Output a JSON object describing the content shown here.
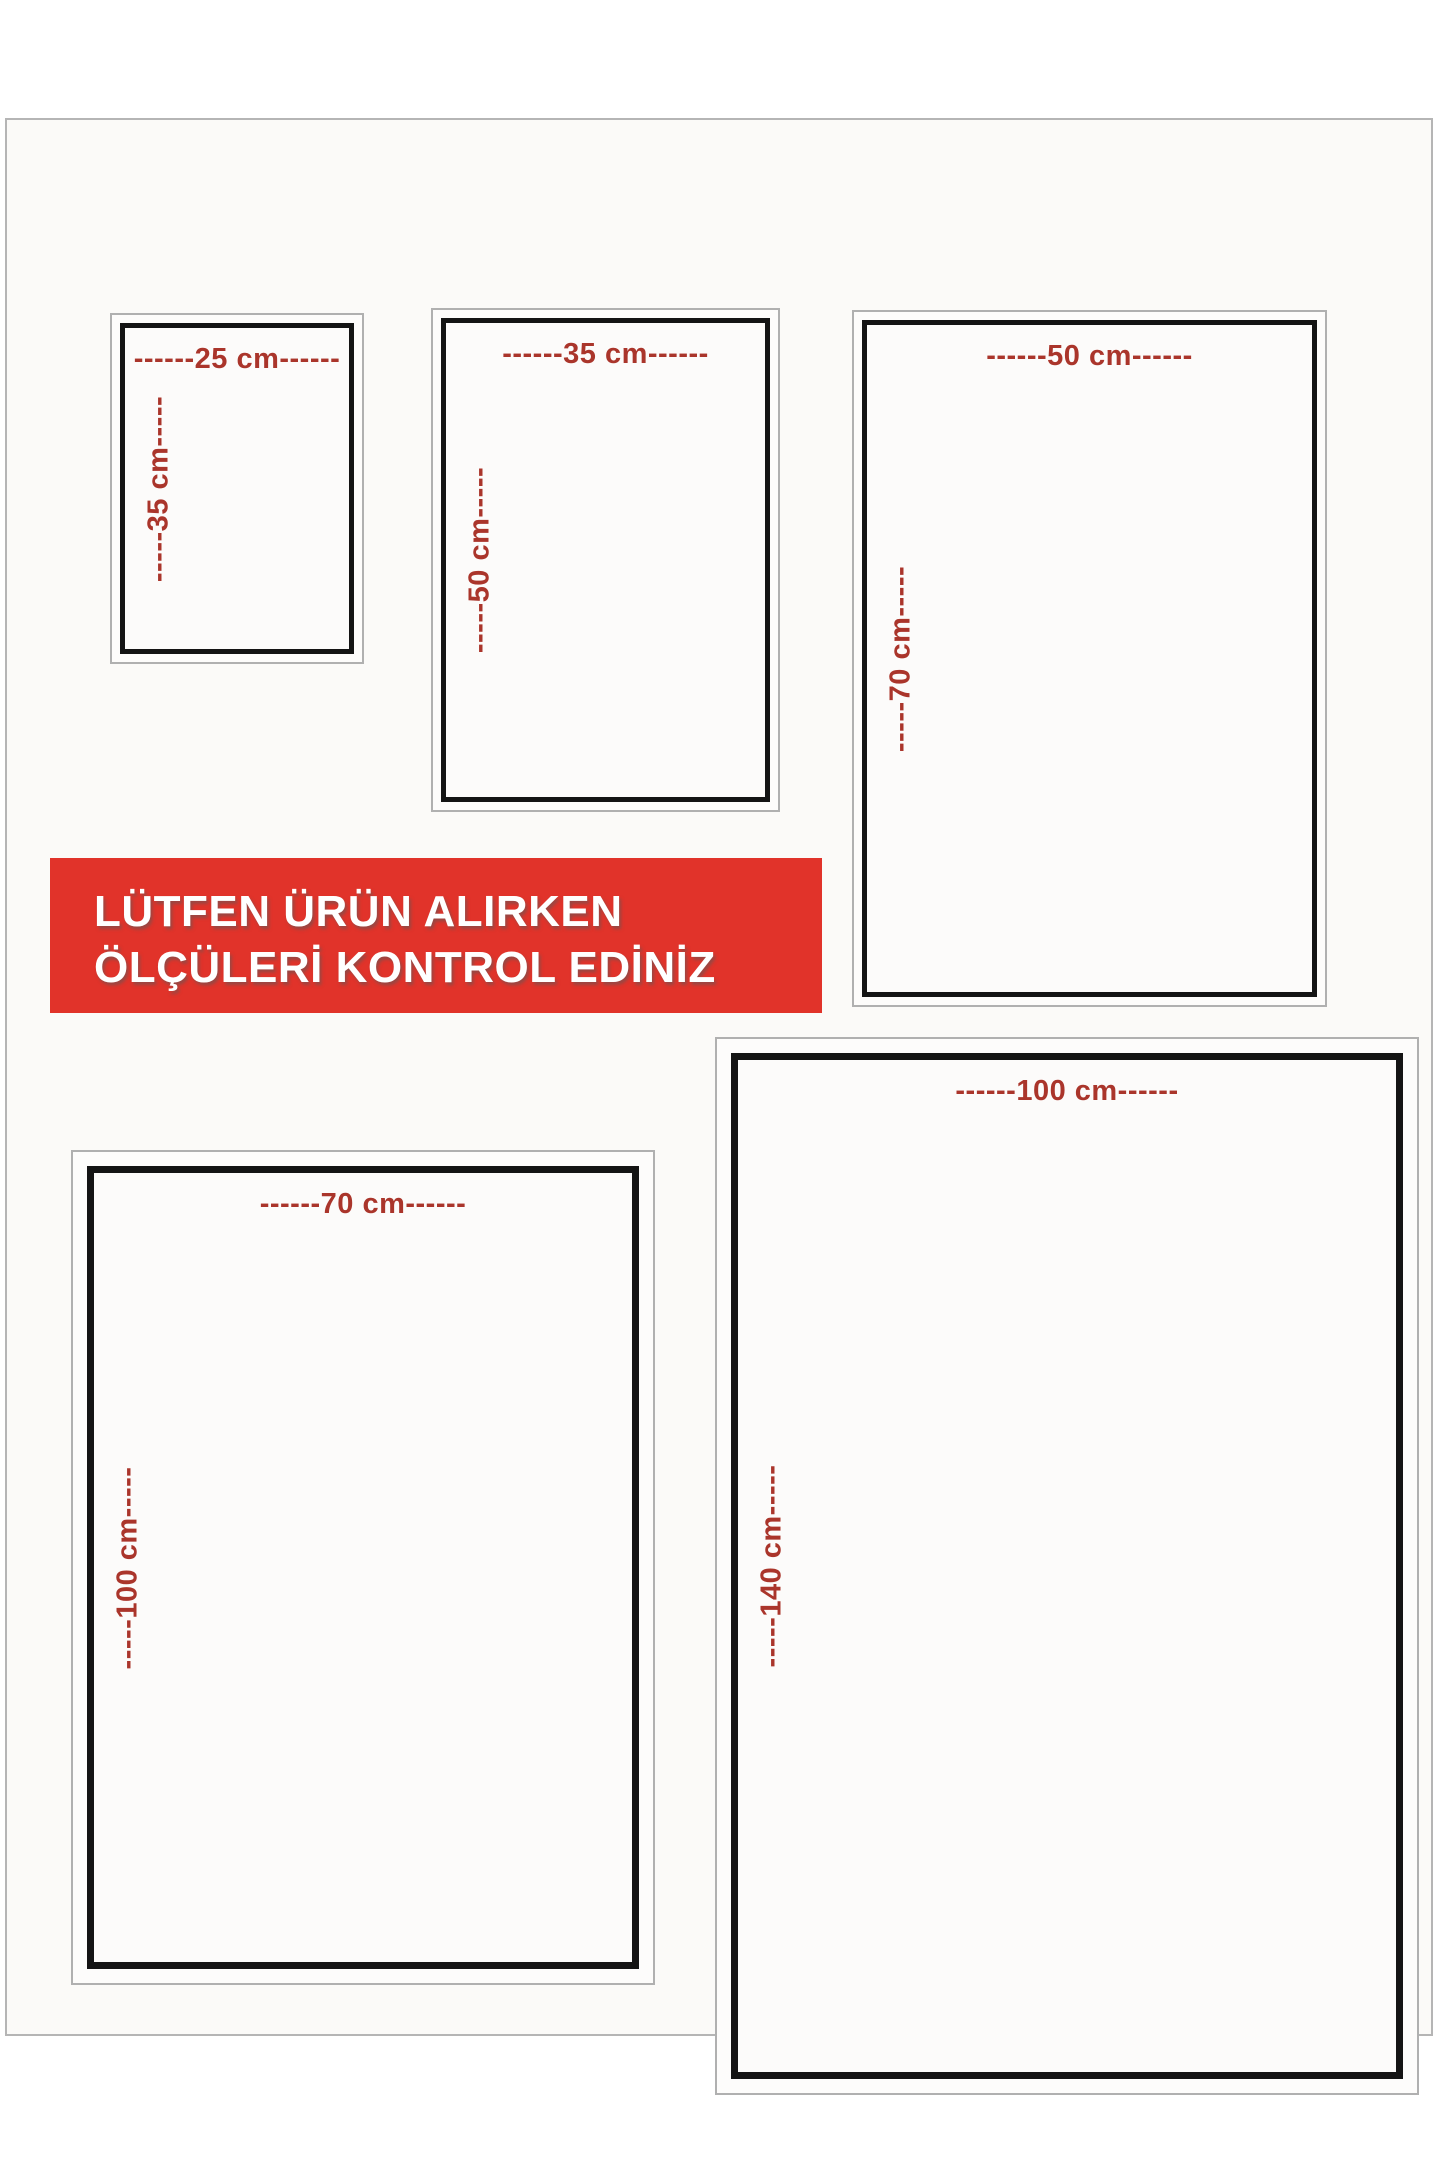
{
  "banner": {
    "line1": "LÜTFEN ÜRÜN ALIRKEN",
    "line2": "ÖLÇÜLERİ KONTROL EDİNİZ",
    "bg_color": "#e1332a",
    "text_color": "#ffffff"
  },
  "boxes": [
    {
      "name": "size-25x35",
      "width_cm": 25,
      "height_cm": 35,
      "width_label": "------25 cm------",
      "height_label": "-----35 cm-----"
    },
    {
      "name": "size-35x50",
      "width_cm": 35,
      "height_cm": 50,
      "width_label": "------35 cm------",
      "height_label": "-----50 cm-----"
    },
    {
      "name": "size-50x70",
      "width_cm": 50,
      "height_cm": 70,
      "width_label": "------50 cm------",
      "height_label": "-----70 cm-----"
    },
    {
      "name": "size-70x100",
      "width_cm": 70,
      "height_cm": 100,
      "width_label": "------70 cm------",
      "height_label": "-----100 cm-----"
    },
    {
      "name": "size-100x140",
      "width_cm": 100,
      "height_cm": 140,
      "width_label": "------100 cm------",
      "height_label": "-----140 cm-----"
    }
  ],
  "colors": {
    "dimension_text": "#aa352b",
    "banner_red": "#e1332a",
    "border_black": "#141414",
    "border_gray": "#b0b0b0",
    "page_bg": "#fbfaf8"
  }
}
